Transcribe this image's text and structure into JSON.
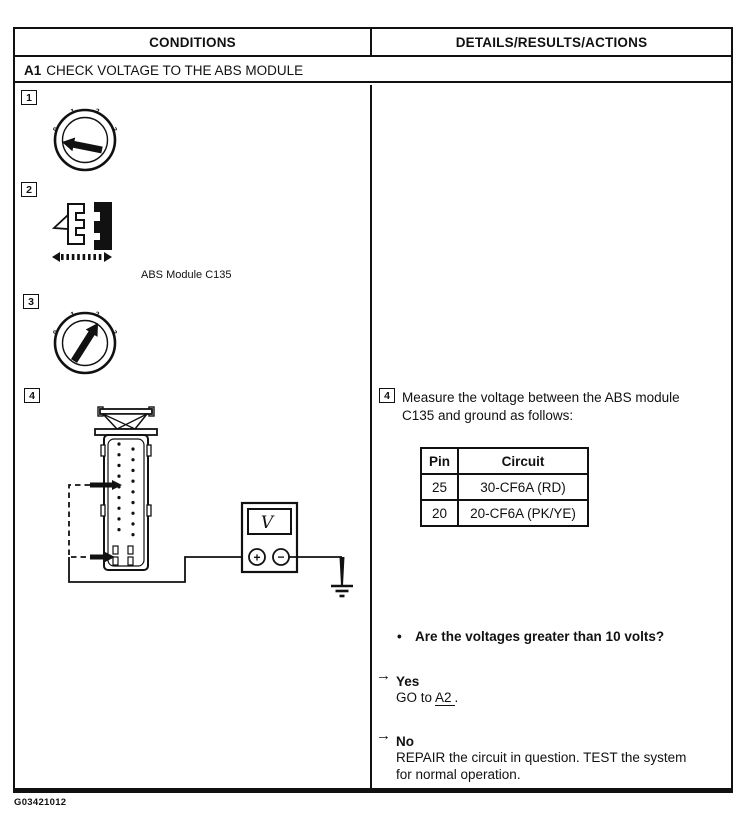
{
  "table": {
    "header": {
      "conditions": "CONDITIONS",
      "details": "DETAILS/RESULTS/ACTIONS"
    },
    "test": {
      "id": "A1",
      "title": "CHECK VOLTAGE TO THE ABS MODULE"
    }
  },
  "conditions": {
    "steps": [
      {
        "number": "1"
      },
      {
        "number": "2",
        "caption": "ABS Module C135"
      },
      {
        "number": "3"
      },
      {
        "number": "4"
      }
    ],
    "ignition_positions": [
      "0",
      "1",
      "2",
      "3"
    ]
  },
  "details": {
    "step_number": "4",
    "instruction": "Measure the voltage between the ABS module C135 and ground as follows:",
    "pin_table": {
      "headers": [
        "Pin",
        "Circuit"
      ],
      "rows": [
        {
          "pin": "25",
          "circuit": "30-CF6A (RD)"
        },
        {
          "pin": "20",
          "circuit": "20-CF6A (PK/YE)"
        }
      ]
    },
    "bullet": "•",
    "question": "Are the voltages greater than 10 volts?",
    "results": [
      {
        "arrow": "→",
        "answer": "Yes",
        "action_prefix": "GO to ",
        "link": "A2",
        "action_suffix": "."
      },
      {
        "arrow": "→",
        "answer": "No",
        "action": "REPAIR the circuit in question. TEST the system for normal operation."
      }
    ]
  },
  "diagram_labels": {
    "voltmeter_display": "V",
    "voltmeter_plus": "+",
    "voltmeter_minus": "−"
  },
  "footer": {
    "figure_id": "G03421012"
  },
  "colors": {
    "ink": "#111111",
    "paper": "#ffffff"
  }
}
